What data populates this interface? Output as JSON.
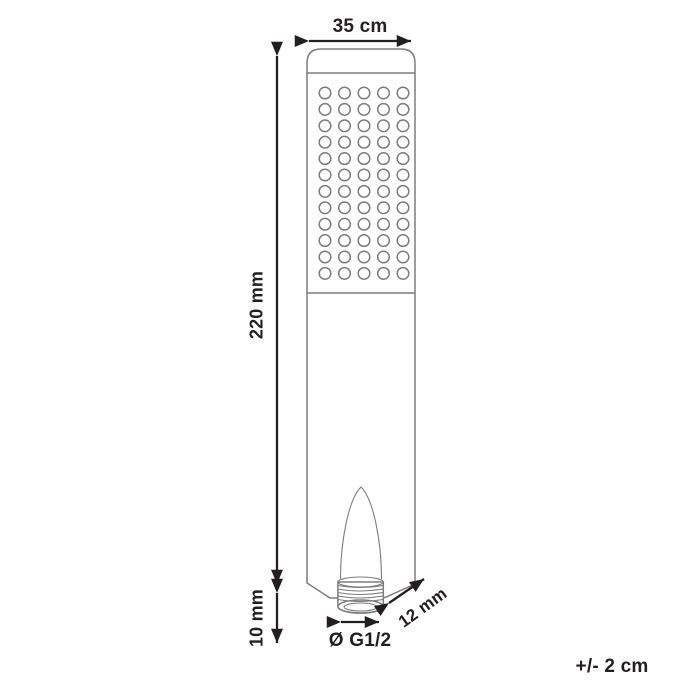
{
  "diagram": {
    "title": "Hand shower dimension drawing",
    "labels": {
      "width": "35 cm",
      "height": "220 mm",
      "connector_height": "10 mm",
      "connector_diameter": "Ø G1/2",
      "thread_length": "12 mm",
      "tolerance": "+/- 2 cm"
    },
    "nozzles": {
      "columns": 5,
      "rows": 12
    },
    "colors": {
      "outline": "#7d7d7d",
      "dimension": "#231f20",
      "background": "#ffffff"
    }
  }
}
